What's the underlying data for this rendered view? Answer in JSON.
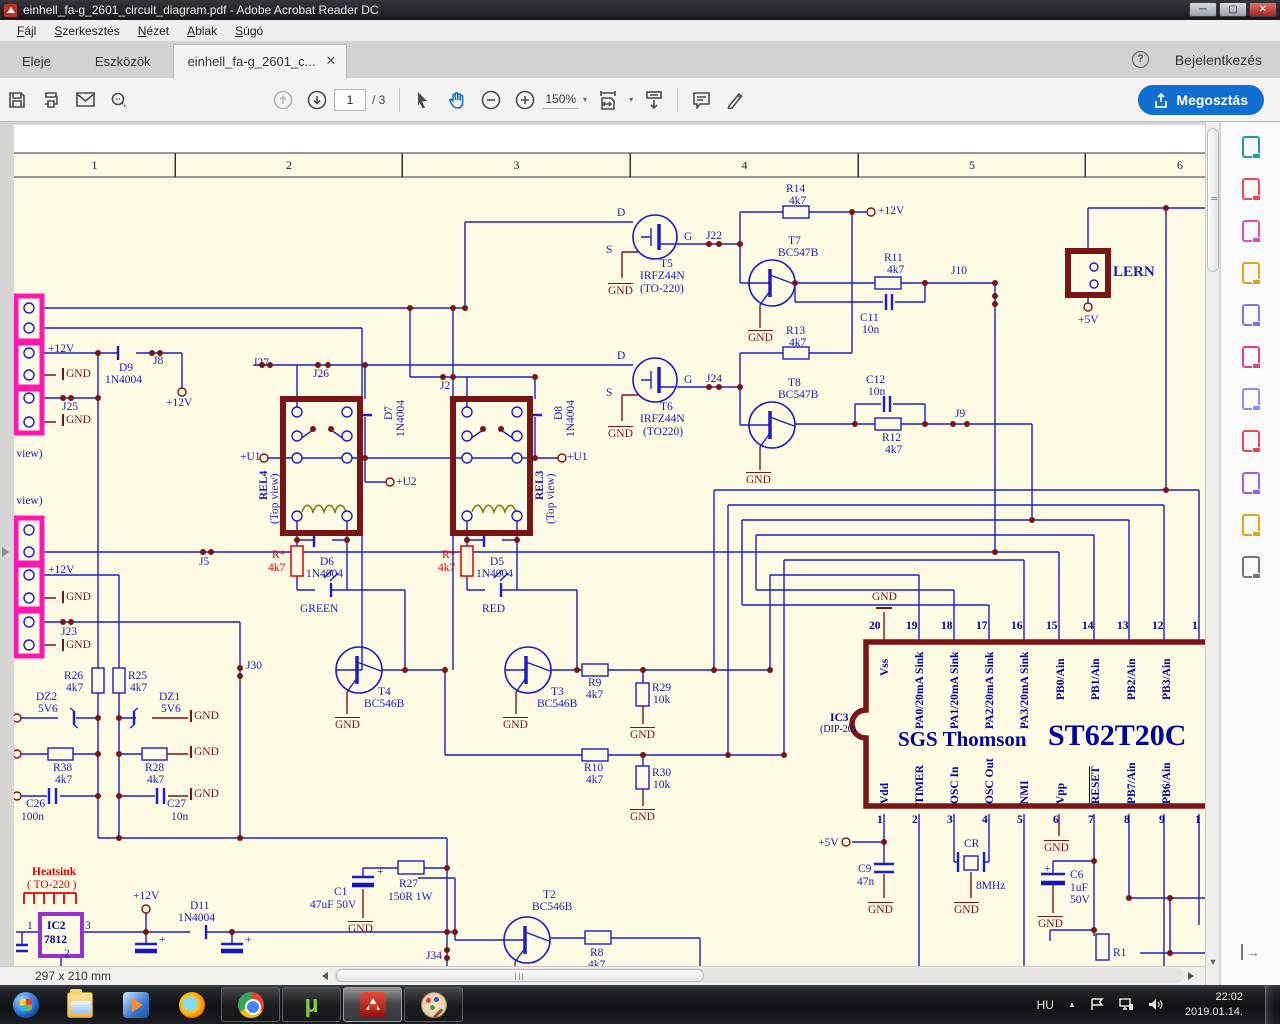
{
  "window": {
    "title": "einhell_fa-g_2601_circuit_diagram.pdf - Adobe Acrobat Reader DC"
  },
  "menu": {
    "items": [
      "Fájl",
      "Szerkesztés",
      "Nézet",
      "Ablak",
      "Súgó"
    ]
  },
  "tabs": {
    "home": "Eleje",
    "tools": "Eszközök",
    "doc": "einhell_fa-g_2601_c...",
    "signin": "Bejelentkezés"
  },
  "toolbar": {
    "page_current": "1",
    "page_total": "/ 3",
    "zoom": "150%",
    "share": "Megosztás"
  },
  "statusbar": {
    "size": "297 x 210 mm"
  },
  "sidebar": {
    "tools": [
      {
        "name": "export-pdf-icon",
        "color": "#1a9ba8"
      },
      {
        "name": "create-pdf-icon",
        "color": "#ea4656"
      },
      {
        "name": "edit-pdf-icon",
        "color": "#d94fb2"
      },
      {
        "name": "comment-icon",
        "color": "#d8a619"
      },
      {
        "name": "combine-files-icon",
        "color": "#7d74ee"
      },
      {
        "name": "fill-sign-icon",
        "color": "#e23e84"
      },
      {
        "name": "protect-icon",
        "color": "#8d8df2"
      },
      {
        "name": "optimize-pdf-icon",
        "color": "#ea4656"
      },
      {
        "name": "sign-icon",
        "color": "#9a5df0"
      },
      {
        "name": "send-comments-icon",
        "color": "#d8a619"
      },
      {
        "name": "more-tools-icon",
        "color": "#777777"
      }
    ]
  },
  "taskbar": {
    "apps": [
      {
        "id": "start-button"
      },
      {
        "id": "explorer"
      },
      {
        "id": "media-player"
      },
      {
        "id": "firefox"
      },
      {
        "id": "chrome",
        "boxed": true
      },
      {
        "id": "utorrent",
        "boxed": true
      },
      {
        "id": "adobe-reader",
        "boxed": true,
        "active": true
      },
      {
        "id": "paint",
        "boxed": true
      }
    ],
    "tray": {
      "lang": "HU",
      "time": "22:02",
      "date": "2019.01.14."
    }
  },
  "schematic": {
    "columns": [
      "1",
      "2",
      "3",
      "4",
      "5",
      "6"
    ],
    "labels": [
      {
        "t": "D",
        "x": 617,
        "y": 207
      },
      {
        "t": "G",
        "x": 684,
        "y": 231
      },
      {
        "t": "S",
        "x": 606,
        "y": 244
      },
      {
        "t": "T5",
        "x": 660,
        "y": 258
      },
      {
        "t": "IRFZ44N",
        "x": 640,
        "y": 270
      },
      {
        "t": "(TO-220)",
        "x": 640,
        "y": 283
      },
      {
        "t": "GND",
        "x": 608,
        "y": 283,
        "c": "dr",
        "bar": "t"
      },
      {
        "t": "J22",
        "x": 706,
        "y": 230
      },
      {
        "t": "R14",
        "x": 786,
        "y": 183
      },
      {
        "t": "4k7",
        "x": 789,
        "y": 195
      },
      {
        "t": "+12V",
        "x": 878,
        "y": 205
      },
      {
        "t": "T7",
        "x": 788,
        "y": 235
      },
      {
        "t": "BC547B",
        "x": 778,
        "y": 247
      },
      {
        "t": "GND",
        "x": 748,
        "y": 330,
        "c": "dr",
        "bar": "t"
      },
      {
        "t": "R11",
        "x": 884,
        "y": 252
      },
      {
        "t": "4k7",
        "x": 887,
        "y": 264
      },
      {
        "t": "C11",
        "x": 860,
        "y": 312
      },
      {
        "t": "10n",
        "x": 862,
        "y": 324
      },
      {
        "t": "J10",
        "x": 951,
        "y": 265
      },
      {
        "t": "LERN",
        "x": 1113,
        "y": 265,
        "fs": 15,
        "w": 1
      },
      {
        "t": "+5V",
        "x": 1078,
        "y": 314
      },
      {
        "t": "D",
        "x": 617,
        "y": 350
      },
      {
        "t": "G",
        "x": 684,
        "y": 374
      },
      {
        "t": "S",
        "x": 606,
        "y": 387
      },
      {
        "t": "T6",
        "x": 660,
        "y": 401
      },
      {
        "t": "IRFZ44N",
        "x": 640,
        "y": 413
      },
      {
        "t": "(TO220)",
        "x": 643,
        "y": 426
      },
      {
        "t": "GND",
        "x": 608,
        "y": 426,
        "c": "dr",
        "bar": "t"
      },
      {
        "t": "J24",
        "x": 706,
        "y": 373
      },
      {
        "t": "R13",
        "x": 786,
        "y": 325
      },
      {
        "t": "4k7",
        "x": 789,
        "y": 337
      },
      {
        "t": "T8",
        "x": 788,
        "y": 377
      },
      {
        "t": "BC547B",
        "x": 778,
        "y": 389
      },
      {
        "t": "GND",
        "x": 746,
        "y": 472,
        "c": "dr",
        "bar": "t"
      },
      {
        "t": "C12",
        "x": 866,
        "y": 374
      },
      {
        "t": "10n",
        "x": 868,
        "y": 386
      },
      {
        "t": "R12",
        "x": 882,
        "y": 432
      },
      {
        "t": "4k7",
        "x": 885,
        "y": 444
      },
      {
        "t": "J9",
        "x": 955,
        "y": 408
      },
      {
        "t": "J27",
        "x": 253,
        "y": 357
      },
      {
        "t": "J26",
        "x": 313,
        "y": 368
      },
      {
        "t": "J2",
        "x": 440,
        "y": 380
      },
      {
        "t": "D7",
        "x": 383,
        "y": 420,
        "rot": 1
      },
      {
        "t": "1N4004",
        "x": 395,
        "y": 437,
        "rot": 1
      },
      {
        "t": "D8",
        "x": 553,
        "y": 420,
        "rot": 1
      },
      {
        "t": "1N4004",
        "x": 565,
        "y": 437,
        "rot": 1
      },
      {
        "t": "REL4",
        "x": 258,
        "y": 500,
        "rot": 1,
        "w": 1
      },
      {
        "t": "(Top view)",
        "x": 269,
        "y": 524,
        "rot": 1
      },
      {
        "t": "REL3",
        "x": 534,
        "y": 500,
        "rot": 1,
        "w": 1
      },
      {
        "t": "(Top view)",
        "x": 545,
        "y": 524,
        "rot": 1
      },
      {
        "t": "+U1",
        "x": 240,
        "y": 451
      },
      {
        "t": "+U1",
        "x": 567,
        "y": 451
      },
      {
        "t": "+U2",
        "x": 396,
        "y": 476
      },
      {
        "t": "D6",
        "x": 320,
        "y": 556
      },
      {
        "t": "1N4004",
        "x": 306,
        "y": 568
      },
      {
        "t": "R*",
        "x": 272,
        "y": 549,
        "c": "r"
      },
      {
        "t": "4k7",
        "x": 268,
        "y": 562,
        "c": "r"
      },
      {
        "t": "GREEN",
        "x": 300,
        "y": 603
      },
      {
        "t": "D5",
        "x": 490,
        "y": 556
      },
      {
        "t": "1N4004",
        "x": 476,
        "y": 568
      },
      {
        "t": "R*",
        "x": 442,
        "y": 549,
        "c": "r"
      },
      {
        "t": "4k7",
        "x": 438,
        "y": 562,
        "c": "r"
      },
      {
        "t": "RED",
        "x": 482,
        "y": 603
      },
      {
        "t": "+12V",
        "x": 48,
        "y": 343
      },
      {
        "t": "GND",
        "x": 62,
        "y": 368,
        "c": "dr",
        "bar": "l"
      },
      {
        "t": "J25",
        "x": 62,
        "y": 401
      },
      {
        "t": "GND",
        "x": 62,
        "y": 414,
        "c": "dr",
        "bar": "l"
      },
      {
        "t": "D9",
        "x": 119,
        "y": 362
      },
      {
        "t": "1N4004",
        "x": 105,
        "y": 374
      },
      {
        "t": "J8",
        "x": 153,
        "y": 355
      },
      {
        "t": "+12V",
        "x": 166,
        "y": 397
      },
      {
        "t": "op view)",
        "x": 2,
        "y": 448
      },
      {
        "t": "op view)",
        "x": 2,
        "y": 495
      },
      {
        "t": "+12V",
        "x": 48,
        "y": 564
      },
      {
        "t": "GND",
        "x": 62,
        "y": 591,
        "c": "dr",
        "bar": "l"
      },
      {
        "t": "J23",
        "x": 61,
        "y": 626
      },
      {
        "t": "GND",
        "x": 62,
        "y": 639,
        "c": "dr",
        "bar": "l"
      },
      {
        "t": "J5",
        "x": 199,
        "y": 556
      },
      {
        "t": "J30",
        "x": 246,
        "y": 660
      },
      {
        "t": "R26",
        "x": 64,
        "y": 670
      },
      {
        "t": "4k7",
        "x": 66,
        "y": 682
      },
      {
        "t": "R25",
        "x": 128,
        "y": 670
      },
      {
        "t": "4k7",
        "x": 130,
        "y": 682
      },
      {
        "t": "DZ2",
        "x": 36,
        "y": 691
      },
      {
        "t": "5V6",
        "x": 38,
        "y": 703
      },
      {
        "t": "DZ1",
        "x": 159,
        "y": 691
      },
      {
        "t": "5V6",
        "x": 161,
        "y": 703
      },
      {
        "t": "GND",
        "x": 190,
        "y": 710,
        "c": "dr",
        "bar": "l"
      },
      {
        "t": "R38",
        "x": 53,
        "y": 762
      },
      {
        "t": "4k7",
        "x": 55,
        "y": 774
      },
      {
        "t": "R28",
        "x": 145,
        "y": 762
      },
      {
        "t": "4k7",
        "x": 147,
        "y": 774
      },
      {
        "t": "GND",
        "x": 190,
        "y": 746,
        "c": "dr",
        "bar": "l"
      },
      {
        "t": "C26",
        "x": 26,
        "y": 798
      },
      {
        "t": "100n",
        "x": 21,
        "y": 811
      },
      {
        "t": "C27",
        "x": 167,
        "y": 798
      },
      {
        "t": "10n",
        "x": 171,
        "y": 811
      },
      {
        "t": "GND",
        "x": 190,
        "y": 788,
        "c": "dr",
        "bar": "l"
      },
      {
        "t": "T4",
        "x": 378,
        "y": 686
      },
      {
        "t": "BC546B",
        "x": 364,
        "y": 698
      },
      {
        "t": "GND",
        "x": 335,
        "y": 717,
        "c": "dr",
        "bar": "t"
      },
      {
        "t": "T3",
        "x": 551,
        "y": 686
      },
      {
        "t": "BC546B",
        "x": 537,
        "y": 698
      },
      {
        "t": "GND",
        "x": 503,
        "y": 717,
        "c": "dr",
        "bar": "t"
      },
      {
        "t": "R9",
        "x": 588,
        "y": 677
      },
      {
        "t": "4k7",
        "x": 586,
        "y": 689
      },
      {
        "t": "R29",
        "x": 652,
        "y": 682
      },
      {
        "t": "10k",
        "x": 653,
        "y": 694
      },
      {
        "t": "GND",
        "x": 630,
        "y": 727,
        "c": "dr",
        "bar": "t"
      },
      {
        "t": "R10",
        "x": 584,
        "y": 762
      },
      {
        "t": "4k7",
        "x": 586,
        "y": 774
      },
      {
        "t": "R30",
        "x": 652,
        "y": 767
      },
      {
        "t": "10k",
        "x": 653,
        "y": 779
      },
      {
        "t": "GND",
        "x": 630,
        "y": 809,
        "c": "dr",
        "bar": "t"
      },
      {
        "t": "Heatsink",
        "x": 32,
        "y": 866,
        "c": "r",
        "w": 1
      },
      {
        "t": "( TO-220 )",
        "x": 27,
        "y": 879,
        "c": "r"
      },
      {
        "t": "IC2",
        "x": 47,
        "y": 920,
        "c": "nb",
        "w": 1
      },
      {
        "t": "7812",
        "x": 44,
        "y": 934,
        "c": "nb",
        "w": 1
      },
      {
        "t": "1",
        "x": 27,
        "y": 920
      },
      {
        "t": "3",
        "x": 85,
        "y": 920
      },
      {
        "t": "2",
        "x": 64,
        "y": 948
      },
      {
        "t": "+12V",
        "x": 133,
        "y": 890
      },
      {
        "t": "D11",
        "x": 190,
        "y": 900
      },
      {
        "t": "1N4004",
        "x": 178,
        "y": 912
      },
      {
        "t": "C1",
        "x": 334,
        "y": 886
      },
      {
        "t": "47uF 50V",
        "x": 310,
        "y": 899
      },
      {
        "t": "+",
        "x": 377,
        "y": 866
      },
      {
        "t": "R27",
        "x": 399,
        "y": 878
      },
      {
        "t": "150R 1W",
        "x": 388,
        "y": 891
      },
      {
        "t": "GND",
        "x": 348,
        "y": 921,
        "c": "dr",
        "bar": "t"
      },
      {
        "t": "+",
        "x": 159,
        "y": 934
      },
      {
        "t": "+",
        "x": 245,
        "y": 934
      },
      {
        "t": "J34",
        "x": 426,
        "y": 950
      },
      {
        "t": "T2",
        "x": 543,
        "y": 889
      },
      {
        "t": "BC546B",
        "x": 532,
        "y": 901
      },
      {
        "t": "R8",
        "x": 590,
        "y": 947
      },
      {
        "t": "4k7",
        "x": 588,
        "y": 959
      },
      {
        "t": "GND",
        "x": 872,
        "y": 591,
        "c": "dr"
      },
      {
        "t": "IC3",
        "x": 830,
        "y": 712,
        "c": "nb",
        "w": 1
      },
      {
        "t": "(DIP-20)",
        "x": 820,
        "y": 725,
        "c": "nb",
        "fs": 10
      },
      {
        "t": "20",
        "x": 869,
        "y": 620,
        "c": "nb",
        "w": 1
      },
      {
        "t": "19",
        "x": 906,
        "y": 620,
        "c": "nb",
        "w": 1
      },
      {
        "t": "18",
        "x": 941,
        "y": 620,
        "c": "nb",
        "w": 1
      },
      {
        "t": "17",
        "x": 976,
        "y": 620,
        "c": "nb",
        "w": 1
      },
      {
        "t": "16",
        "x": 1011,
        "y": 620,
        "c": "nb",
        "w": 1
      },
      {
        "t": "15",
        "x": 1046,
        "y": 620,
        "c": "nb",
        "w": 1
      },
      {
        "t": "14",
        "x": 1082,
        "y": 620,
        "c": "nb",
        "w": 1
      },
      {
        "t": "13",
        "x": 1117,
        "y": 620,
        "c": "nb",
        "w": 1
      },
      {
        "t": "12",
        "x": 1152,
        "y": 620,
        "c": "nb",
        "w": 1
      },
      {
        "t": "1",
        "x": 1192,
        "y": 620,
        "c": "nb",
        "w": 1
      },
      {
        "t": "Vss",
        "x": 879,
        "y": 676,
        "rot": 1,
        "c": "nb",
        "w": 1
      },
      {
        "t": "PA0/20mA Sink",
        "x": 914,
        "y": 729,
        "rot": 1,
        "c": "nb",
        "w": 1
      },
      {
        "t": "PA1/20mA Sink",
        "x": 949,
        "y": 729,
        "rot": 1,
        "c": "nb",
        "w": 1
      },
      {
        "t": "PA2/20mA Sink",
        "x": 984,
        "y": 729,
        "rot": 1,
        "c": "nb",
        "w": 1
      },
      {
        "t": "PA3/20mA Sink",
        "x": 1019,
        "y": 729,
        "rot": 1,
        "c": "nb",
        "w": 1
      },
      {
        "t": "PB0/Ain",
        "x": 1055,
        "y": 700,
        "rot": 1,
        "c": "nb",
        "w": 1
      },
      {
        "t": "PB1/Ain",
        "x": 1090,
        "y": 700,
        "rot": 1,
        "c": "nb",
        "w": 1
      },
      {
        "t": "PB2/Ain",
        "x": 1126,
        "y": 700,
        "rot": 1,
        "c": "nb",
        "w": 1
      },
      {
        "t": "PB3/Ain",
        "x": 1161,
        "y": 700,
        "rot": 1,
        "c": "nb",
        "w": 1
      },
      {
        "t": "SGS Thomson",
        "x": 898,
        "y": 728,
        "c": "nb",
        "fs": 21,
        "w": 1
      },
      {
        "t": "ST62T20C",
        "x": 1048,
        "y": 720,
        "c": "nb",
        "fs": 30,
        "w": 1
      },
      {
        "t": "Vdd",
        "x": 879,
        "y": 804,
        "rot": 1,
        "c": "nb",
        "w": 1
      },
      {
        "t": "TIMER",
        "x": 914,
        "y": 804,
        "rot": 1,
        "c": "nb",
        "w": 1
      },
      {
        "t": "OSC In",
        "x": 949,
        "y": 804,
        "rot": 1,
        "c": "nb",
        "w": 1
      },
      {
        "t": "OSC Out",
        "x": 984,
        "y": 804,
        "rot": 1,
        "c": "nb",
        "w": 1
      },
      {
        "t": "NMI",
        "x": 1019,
        "y": 804,
        "rot": 1,
        "c": "nb",
        "w": 1
      },
      {
        "t": "Vpp",
        "x": 1055,
        "y": 804,
        "rot": 1,
        "c": "nb",
        "w": 1
      },
      {
        "t": "RESET",
        "x": 1090,
        "y": 804,
        "rot": 1,
        "c": "nb",
        "w": 1,
        "ov": 1
      },
      {
        "t": "PB7/Ain",
        "x": 1126,
        "y": 804,
        "rot": 1,
        "c": "nb",
        "w": 1
      },
      {
        "t": "PB6/Ain",
        "x": 1161,
        "y": 804,
        "rot": 1,
        "c": "nb",
        "w": 1
      },
      {
        "t": "1",
        "x": 877,
        "y": 814,
        "c": "nb",
        "w": 1
      },
      {
        "t": "2",
        "x": 912,
        "y": 814,
        "c": "nb",
        "w": 1
      },
      {
        "t": "3",
        "x": 947,
        "y": 814,
        "c": "nb",
        "w": 1
      },
      {
        "t": "4",
        "x": 982,
        "y": 814,
        "c": "nb",
        "w": 1
      },
      {
        "t": "5",
        "x": 1017,
        "y": 814,
        "c": "nb",
        "w": 1
      },
      {
        "t": "6",
        "x": 1053,
        "y": 814,
        "c": "nb",
        "w": 1
      },
      {
        "t": "7",
        "x": 1088,
        "y": 814,
        "c": "nb",
        "w": 1
      },
      {
        "t": "8",
        "x": 1124,
        "y": 814,
        "c": "nb",
        "w": 1
      },
      {
        "t": "9",
        "x": 1159,
        "y": 814,
        "c": "nb",
        "w": 1
      },
      {
        "t": "1",
        "x": 1195,
        "y": 814,
        "c": "nb",
        "w": 1
      },
      {
        "t": "+5V",
        "x": 818,
        "y": 837
      },
      {
        "t": "C9",
        "x": 858,
        "y": 863
      },
      {
        "t": "47n",
        "x": 857,
        "y": 876
      },
      {
        "t": "GND",
        "x": 868,
        "y": 902,
        "c": "dr",
        "bar": "t"
      },
      {
        "t": "CR",
        "x": 964,
        "y": 838
      },
      {
        "t": "8MHz",
        "x": 976,
        "y": 880
      },
      {
        "t": "GND",
        "x": 954,
        "y": 902,
        "c": "dr",
        "bar": "t"
      },
      {
        "t": "GND",
        "x": 1044,
        "y": 840,
        "c": "dr",
        "bar": "t"
      },
      {
        "t": "C6",
        "x": 1070,
        "y": 869
      },
      {
        "t": "1uF",
        "x": 1070,
        "y": 882
      },
      {
        "t": "50V",
        "x": 1070,
        "y": 894
      },
      {
        "t": "+",
        "x": 1044,
        "y": 863
      },
      {
        "t": "GND",
        "x": 1038,
        "y": 916,
        "c": "dr",
        "bar": "t"
      },
      {
        "t": "R1",
        "x": 1113,
        "y": 947
      }
    ]
  }
}
